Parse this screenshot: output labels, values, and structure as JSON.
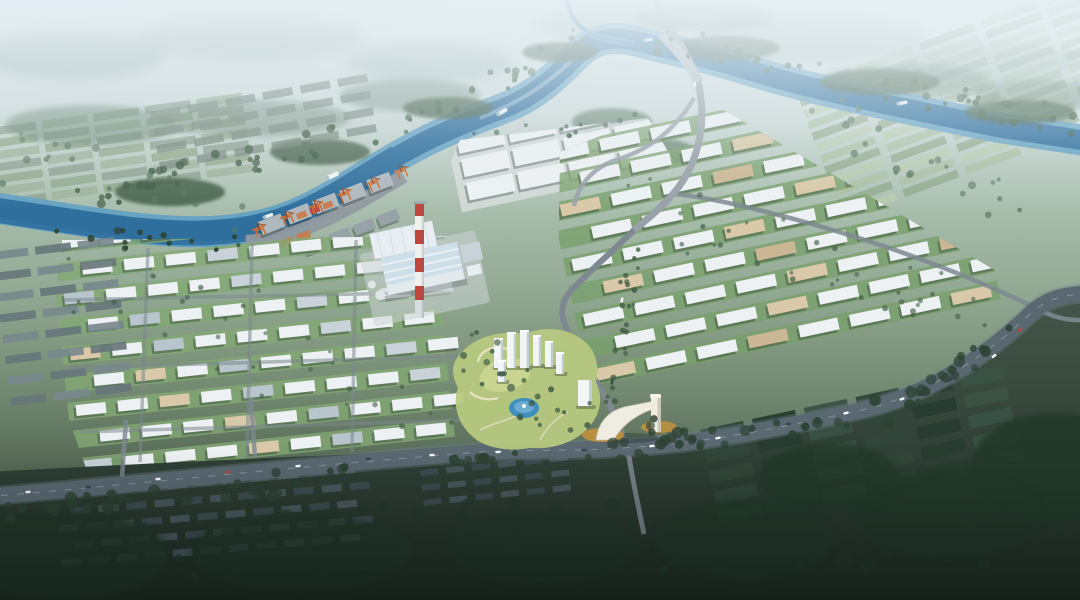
{
  "scene": {
    "description": "Aerial master-plan rendering of a riverside industrial park: winding blue river with cargo port and orange gantry cranes, power plant with red-white striped chimney, grids of white warehouse blocks with green belts, central landscaped park with pond, white residential towers and a white gateway arch over the entry road, arterial road with traffic, dark existing villages, forests and farmland around",
    "palette": {
      "river_deep": "#2f6f9e",
      "river_light": "#64a1c3",
      "river_glint": "#cfe6f2",
      "quay": "#8f99a0",
      "shed_grey": "#aeb8bd",
      "shed_grey2": "#98a3a9",
      "crane_orange": "#cf6e35",
      "crane_dark": "#8f441f",
      "bld_white": "#edf1f3",
      "bld_tan": "#d9c9a8",
      "bld_tan2": "#ccb795",
      "bld_grey": "#c8d2d8",
      "bld_grey2": "#b9c5cc",
      "logi_ground": "#d8dedd",
      "green_strip": "#79a06b",
      "green_strip2": "#83a974",
      "grey_row": "#78878d",
      "grey_row2": "#66757b",
      "grey_green_roof": "#75857b",
      "field_l1": "#8da091",
      "field_l2": "#9db19a",
      "field_a": "#a9bfa0",
      "field_b": "#b9ccae",
      "field_c": "#90a789",
      "roof_orange": "#c97a4a",
      "roof_dark1": "#4b5a61",
      "roof_dark2": "#3e4d54",
      "darkfield_a": "#31463a",
      "darkfield_b": "#283c30",
      "darkfield_c": "#3a5244",
      "tree_mid": "#3f5c44",
      "tree_dark": "#2c4233",
      "forest_far": "#587661",
      "forest_dark": "#24382c",
      "forest_haze": "#8ea69c",
      "road": "#7d8890",
      "road_light": "#98a1a8",
      "road_dark": "#5a6872",
      "lawn": "#b6c87e",
      "lawn_light": "#cdd795",
      "pond": "#3e8fc0",
      "pond_light": "#7db6d6",
      "tower_white": "#f2f5f6",
      "tower_shade": "#c2ccd3",
      "plant_white": "#e9eef2",
      "plant_roof": "#cfdfe9",
      "chimney_red": "#c2453c",
      "chimney_white": "#f0f0ee",
      "chimney_grey": "#d8dde0",
      "gate_white": "#efece2",
      "gate_shade": "#cdc7b6",
      "gold": "#c3913d",
      "car_white": "#f5f7f8",
      "car_dark": "#39434b",
      "car_red": "#b8463c",
      "shadow": "rgba(25,40,35,0.32)"
    },
    "districts": [
      {
        "name": "old-town-north-bank",
        "layer": "north",
        "x": 150,
        "y": 112,
        "rot": -10,
        "rows": 4,
        "cols": 6,
        "cw": 30,
        "ch": 8,
        "gx": 8,
        "gy": 9,
        "fills": [
          "grey_green_roof"
        ],
        "opacity": 0.75
      },
      {
        "name": "left-farm-strips",
        "layer": "fields",
        "x": -10,
        "y": 128,
        "rot": -8,
        "rows": 7,
        "cols": 5,
        "cw": 46,
        "ch": 8,
        "gx": 6,
        "gy": 4,
        "fills": [
          "field_l1",
          "field_l2",
          "field_c"
        ],
        "opacity": 0.85
      },
      {
        "name": "right-farmland",
        "layer": "fields",
        "x": 795,
        "y": 88,
        "rot": -20,
        "rows": 12,
        "cols": 5,
        "cw": 58,
        "ch": 8,
        "gx": 8,
        "gy": 4,
        "fills": [
          "field_a",
          "field_b",
          "field_c"
        ],
        "opacity": 0.8
      },
      {
        "name": "port-warehouses",
        "layer": "port",
        "x": 258,
        "y": 222,
        "rot": -21,
        "rows": 1,
        "cols": 5,
        "cw": 24,
        "ch": 14,
        "gx": 5,
        "gy": 0,
        "fills": [
          "shed_grey"
        ],
        "shadow": true
      },
      {
        "name": "port-warehouses-2",
        "layer": "port",
        "x": 304,
        "y": 244,
        "rot": -21,
        "rows": 1,
        "cols": 4,
        "cw": 21,
        "ch": 11,
        "gx": 5,
        "gy": 0,
        "fills": [
          "shed_grey2"
        ],
        "shadow": true
      },
      {
        "name": "port-containers",
        "layer": "port",
        "x": 296,
        "y": 214,
        "rot": -21,
        "rows": 1,
        "cols": 3,
        "cw": 10,
        "ch": 6,
        "gx": 4,
        "gy": 0,
        "fills": [
          "roof_orange",
          "chimney_red",
          "roof_orange"
        ],
        "opacity": 0.95
      },
      {
        "name": "port-containers-2",
        "layer": "port",
        "x": 262,
        "y": 248,
        "rot": -21,
        "rows": 1,
        "cols": 3,
        "cw": 14,
        "ch": 7,
        "gx": 4,
        "gy": 0,
        "fills": [
          "roof_orange"
        ],
        "opacity": 0.9
      },
      {
        "name": "logistics-complex",
        "layer": "north",
        "x": 456,
        "y": 136,
        "rot": -12,
        "rows": 3,
        "cols": 4,
        "cw": 47,
        "ch": 18,
        "gx": 5,
        "gy": 6,
        "fills": [
          "bld_white"
        ],
        "shadow": true,
        "ground": "logi_ground",
        "clip": "460,140 648,118 672,158 658,218 470,232 442,182"
      },
      {
        "name": "right-warehouse-district",
        "layer": "north",
        "x": 548,
        "y": 150,
        "rot": -12,
        "rows": 9,
        "cols": 8,
        "cw": 40,
        "ch": 12,
        "gx": 12,
        "gy": 16,
        "stagger": true,
        "row_ground": "green_strip",
        "fills": [
          "bld_white",
          "bld_white",
          "bld_white",
          "bld_white",
          "bld_tan",
          "bld_white",
          "bld_white",
          "bld_tan2",
          "bld_white",
          "bld_white",
          "bld_white",
          "bld_tan"
        ],
        "shadow": true,
        "clip": "560,152 700,96 1042,298 1042,312 868,414 556,408"
      },
      {
        "name": "left-industrial-district",
        "layer": "north",
        "x": 58,
        "y": 238,
        "rot": -6,
        "rows": 10,
        "cols": 9,
        "cw": 30,
        "ch": 11,
        "gx": 12,
        "gy": 17,
        "stagger": true,
        "row_ground": "green_strip2",
        "fills": [
          "bld_white",
          "bld_white",
          "bld_grey",
          "bld_white",
          "bld_white",
          "bld_white",
          "bld_tan",
          "bld_white",
          "bld_grey2",
          "bld_white"
        ],
        "shadow": true,
        "clip": "62,240 460,236 475,300 472,452 86,468 48,360"
      },
      {
        "name": "left-existing-strip",
        "layer": "north",
        "x": -8,
        "y": 252,
        "rot": -7,
        "rows": 8,
        "cols": 3,
        "cw": 36,
        "ch": 8,
        "gx": 7,
        "gy": 13,
        "fills": [
          "grey_row",
          "grey_row2"
        ],
        "opacity": 0.9
      },
      {
        "name": "village-rooftops",
        "layer": "south",
        "x": 55,
        "y": 492,
        "rot": -5,
        "rows": 5,
        "cols": 11,
        "cw": 20,
        "ch": 7,
        "gx": 8,
        "gy": 10,
        "stagger": true,
        "fills": [
          "roof_dark1",
          "roof_dark2"
        ],
        "opacity": 0.95
      },
      {
        "name": "village-rooftops-2",
        "layer": "south",
        "x": 420,
        "y": 470,
        "rot": -6,
        "rows": 3,
        "cols": 6,
        "cw": 18,
        "ch": 6,
        "gx": 8,
        "gy": 9,
        "fills": [
          "roof_dark2",
          "roof_dark1"
        ],
        "opacity": 0.9
      },
      {
        "name": "dark-farm-fields",
        "layer": "south",
        "x": 700,
        "y": 430,
        "rot": -12,
        "rows": 5,
        "cols": 6,
        "cw": 44,
        "ch": 13,
        "gx": 9,
        "gy": 8,
        "fills": [
          "darkfield_a",
          "darkfield_b",
          "darkfield_c"
        ],
        "opacity": 0.95
      }
    ],
    "blobs": [
      [
        70,
        55,
        95,
        24,
        "forest_haze",
        0.5,
        4,
        "far"
      ],
      [
        250,
        38,
        115,
        22,
        "forest_haze",
        0.45,
        4,
        "far"
      ],
      [
        430,
        62,
        85,
        20,
        "forest_haze",
        0.45,
        4,
        "far"
      ],
      [
        610,
        24,
        75,
        16,
        "forest_haze",
        0.45,
        4,
        "far"
      ],
      [
        810,
        38,
        115,
        24,
        "forest_haze",
        0.5,
        4,
        "far"
      ],
      [
        990,
        62,
        95,
        22,
        "forest_haze",
        0.5,
        4,
        "far"
      ],
      [
        90,
        125,
        85,
        20,
        "forest_far",
        0.5,
        2,
        "far"
      ],
      [
        255,
        118,
        95,
        18,
        "forest_far",
        0.45,
        2,
        "far"
      ],
      [
        410,
        95,
        70,
        16,
        "forest_far",
        0.45,
        2,
        "far"
      ],
      [
        705,
        18,
        70,
        14,
        "forest_far",
        0.5,
        2,
        "far"
      ],
      [
        905,
        82,
        85,
        18,
        "forest_far",
        0.45,
        2,
        "far"
      ],
      [
        1040,
        95,
        65,
        16,
        "forest_far",
        0.5,
        2,
        "far"
      ],
      [
        170,
        192,
        55,
        14,
        "tree_mid",
        0.85,
        1,
        "near"
      ],
      [
        320,
        152,
        50,
        13,
        "tree_mid",
        0.8,
        1,
        "near"
      ],
      [
        448,
        108,
        45,
        11,
        "tree_mid",
        0.8,
        1,
        "near"
      ],
      [
        560,
        52,
        38,
        10,
        "tree_mid",
        0.85,
        1,
        "near"
      ],
      [
        725,
        48,
        55,
        12,
        "tree_mid",
        0.8,
        1,
        "near"
      ],
      [
        880,
        82,
        60,
        13,
        "tree_mid",
        0.8,
        1,
        "near"
      ],
      [
        1020,
        112,
        55,
        12,
        "tree_mid",
        0.8,
        1,
        "near"
      ],
      [
        612,
        122,
        40,
        14,
        "forest_far",
        0.7,
        1,
        "near"
      ],
      [
        662,
        152,
        34,
        13,
        "forest_far",
        0.7,
        1,
        "near"
      ],
      [
        1055,
        468,
        85,
        55,
        "forest_dark",
        0.9,
        2,
        "south"
      ],
      [
        948,
        515,
        95,
        45,
        "forest_dark",
        0.85,
        2,
        "south"
      ],
      [
        830,
        478,
        70,
        35,
        "forest_dark",
        0.8,
        2,
        "south"
      ],
      [
        60,
        555,
        110,
        45,
        "forest_dark",
        0.8,
        2,
        "south"
      ],
      [
        300,
        552,
        110,
        38,
        "forest_dark",
        0.7,
        2,
        "south"
      ],
      [
        540,
        548,
        95,
        36,
        "forest_dark",
        0.65,
        2,
        "south"
      ],
      [
        745,
        540,
        90,
        40,
        "forest_dark",
        0.8,
        2,
        "south"
      ]
    ],
    "tree_strips": [
      {
        "n": "riverbank-nw-trees",
        "a": [
          70,
          198
        ],
        "b": [
          420,
          120
        ],
        "c": 36,
        "s": 14,
        "r": [
          2,
          4.5
        ],
        "f": "tree_mid",
        "o": 0.9
      },
      {
        "n": "riverbank-bend-trees",
        "a": [
          430,
          112
        ],
        "b": [
          585,
          38
        ],
        "c": 20,
        "s": 12,
        "r": [
          2,
          4
        ],
        "f": "tree_mid",
        "o": 0.9
      },
      {
        "n": "riverbank-ne-trees",
        "a": [
          650,
          38
        ],
        "b": [
          1085,
          125
        ],
        "c": 44,
        "s": 14,
        "r": [
          2,
          4.2
        ],
        "f": "tree_mid",
        "o": 0.85
      },
      {
        "n": "riverbank-sw-trees",
        "a": [
          55,
          238
        ],
        "b": [
          235,
          244
        ],
        "c": 16,
        "s": 10,
        "r": [
          2,
          4
        ],
        "f": "tree_dark",
        "o": 0.9
      },
      {
        "n": "arterial-trees-west",
        "a": [
          5,
          507
        ],
        "b": [
          560,
          462
        ],
        "c": 46,
        "s": 13,
        "r": [
          3,
          6.5
        ],
        "f": "tree_dark",
        "o": 0.88
      },
      {
        "n": "arterial-trees-east",
        "a": [
          560,
          462
        ],
        "b": [
          898,
          410
        ],
        "c": 30,
        "s": 12,
        "r": [
          3,
          6
        ],
        "f": "tree_dark",
        "o": 0.88
      },
      {
        "n": "arterial-curve-trees",
        "a": [
          900,
          404
        ],
        "b": [
          1028,
          318
        ],
        "c": 18,
        "s": 11,
        "r": [
          3,
          6
        ],
        "f": "tree_dark",
        "o": 0.9
      },
      {
        "n": "avenue-trees",
        "a": [
          634,
          234
        ],
        "b": [
          612,
          406
        ],
        "c": 22,
        "s": 8,
        "r": [
          1.8,
          3.2
        ],
        "f": "tree_mid",
        "o": 0.9
      },
      {
        "n": "park-trees",
        "a": [
          468,
          348
        ],
        "b": [
          598,
          440
        ],
        "c": 26,
        "s": 22,
        "r": [
          2,
          4
        ],
        "f": "tree_mid",
        "o": 0.85
      },
      {
        "n": "right-district-green-belts",
        "a": [
          640,
          210
        ],
        "b": [
          1000,
          308
        ],
        "c": 34,
        "s": 34,
        "r": [
          1.6,
          3
        ],
        "f": "tree_mid",
        "o": 0.7
      },
      {
        "n": "left-district-green-belts",
        "a": [
          90,
          280
        ],
        "b": [
          440,
          420
        ],
        "c": 30,
        "s": 42,
        "r": [
          1.6,
          3
        ],
        "f": "tree_mid",
        "o": 0.65
      },
      {
        "n": "south-band-trees",
        "a": [
          30,
          540
        ],
        "b": [
          1050,
          538
        ],
        "c": 60,
        "s": 38,
        "r": [
          3,
          8
        ],
        "f": "forest_dark",
        "o": 0.85
      },
      {
        "n": "left-field-hedges",
        "a": [
          0,
          150
        ],
        "b": [
          255,
          225
        ],
        "c": 18,
        "s": 26,
        "r": [
          2,
          4
        ],
        "f": "forest_far",
        "o": 0.8
      },
      {
        "n": "right-farm-hedges",
        "a": [
          820,
          115
        ],
        "b": [
          1080,
          240
        ],
        "c": 22,
        "s": 26,
        "r": [
          2,
          4
        ],
        "f": "forest_far",
        "o": 0.8
      },
      {
        "n": "logistics-north-trees",
        "a": [
          462,
          140
        ],
        "b": [
          652,
          118
        ],
        "c": 12,
        "s": 8,
        "r": [
          1.8,
          3
        ],
        "f": "tree_mid",
        "o": 0.85
      },
      {
        "n": "gate-area-trees",
        "a": [
          650,
          420
        ],
        "b": [
          700,
          450
        ],
        "c": 8,
        "s": 14,
        "r": [
          2.5,
          5
        ],
        "f": "tree_dark",
        "o": 0.85
      }
    ],
    "cranes": {
      "rot": -22,
      "positions": [
        [
          262,
          236
        ],
        [
          290,
          224
        ],
        [
          319,
          213
        ],
        [
          347,
          201
        ],
        [
          376,
          190
        ],
        [
          404,
          178
        ]
      ]
    },
    "ships": [
      [
        332,
        176,
        -24,
        15,
        4.5
      ],
      [
        268,
        216,
        -20,
        11,
        3.5
      ],
      [
        502,
        112,
        -30,
        12,
        4
      ],
      [
        648,
        40,
        -8,
        10,
        3
      ],
      [
        902,
        103,
        -11,
        11,
        3.5
      ]
    ],
    "cars": [
      [
        28,
        492,
        -4,
        "car_white"
      ],
      [
        88,
        487,
        -4,
        "car_dark"
      ],
      [
        158,
        479,
        -4,
        "car_white"
      ],
      [
        228,
        472,
        -5,
        "car_red"
      ],
      [
        298,
        466,
        -5,
        "car_white"
      ],
      [
        368,
        459,
        -4,
        "car_dark"
      ],
      [
        432,
        455,
        -3,
        "car_white"
      ],
      [
        498,
        452,
        -2,
        "car_white"
      ],
      [
        584,
        450,
        -3,
        "car_dark"
      ],
      [
        652,
        446,
        -5,
        "car_white"
      ],
      [
        718,
        438,
        -8,
        "car_white"
      ],
      [
        788,
        424,
        -11,
        "car_dark"
      ],
      [
        846,
        413,
        -13,
        "car_white"
      ],
      [
        902,
        399,
        -19,
        "car_white"
      ],
      [
        950,
        380,
        -28,
        "car_dark"
      ],
      [
        994,
        356,
        -37,
        "car_white"
      ],
      [
        1020,
        330,
        -48,
        "car_red"
      ],
      [
        695,
        84,
        82,
        "car_white"
      ],
      [
        688,
        56,
        82,
        "car_dark"
      ],
      [
        622,
        300,
        -78,
        "car_white"
      ],
      [
        612,
        382,
        -82,
        "car_dark"
      ]
    ],
    "towers": [
      {
        "x": 494,
        "y": 338,
        "w": 9,
        "h": 30
      },
      {
        "x": 507,
        "y": 332,
        "w": 9,
        "h": 36
      },
      {
        "x": 520,
        "y": 330,
        "w": 9,
        "h": 38
      },
      {
        "x": 533,
        "y": 335,
        "w": 8,
        "h": 31
      },
      {
        "x": 545,
        "y": 341,
        "w": 8,
        "h": 26
      },
      {
        "x": 498,
        "y": 360,
        "w": 8,
        "h": 22
      },
      {
        "x": 556,
        "y": 352,
        "w": 8,
        "h": 22
      }
    ]
  }
}
